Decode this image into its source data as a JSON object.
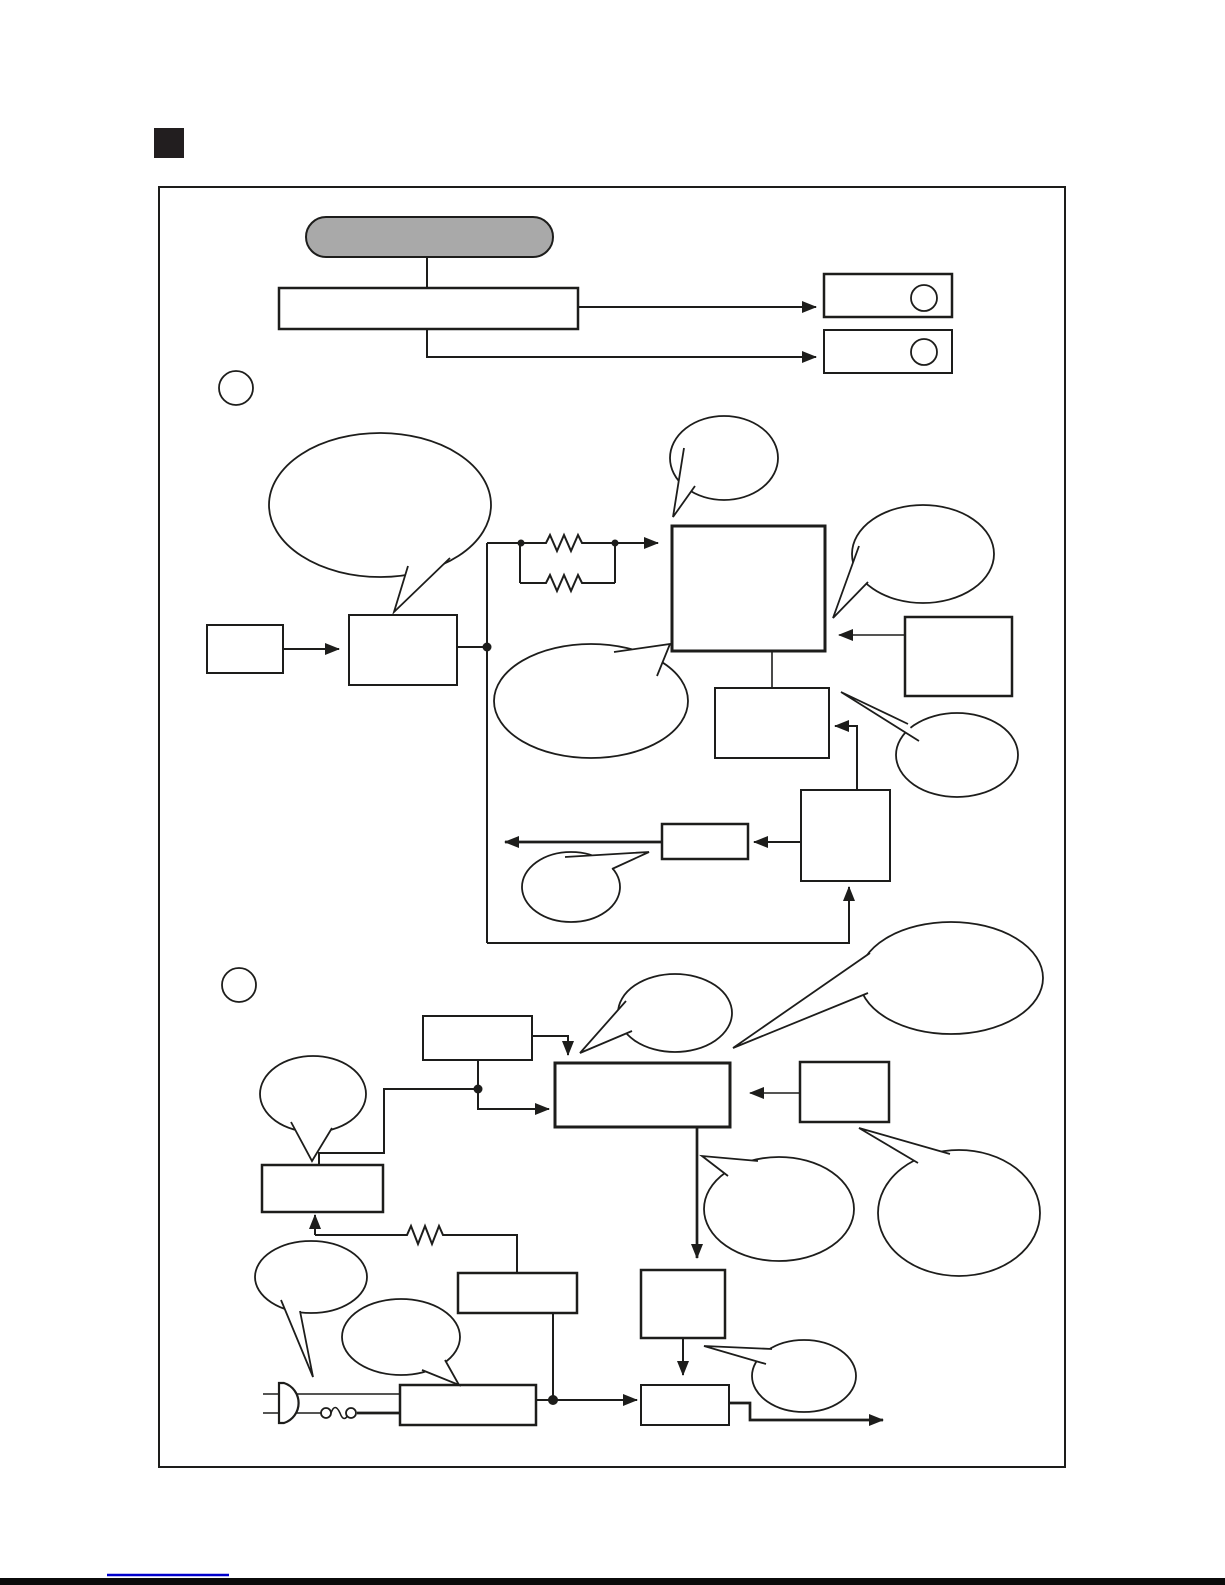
{
  "colors": {
    "ink": "#1d1d1b",
    "pill_fill": "#a9a9a9",
    "shape_fill": "#ffffff",
    "blue_underline": "#0000cc",
    "bottom_bar": "#0b0b0b",
    "marker_square": "#221e1f"
  },
  "diagram": {
    "description": "Service-manual style two-section flow/block diagram; every shape is blank (no text rendered in the screenshot)",
    "section_count": 2,
    "shape_counts": {
      "rectangle_boxes": 18,
      "rounded_start_pill": 1,
      "speech_bubbles": 14,
      "resistor_symbols": 3,
      "junction_dots": 5,
      "indicator_circle_boxes": 2,
      "section_marker_circles": 2,
      "ac_plug_symbols": 1,
      "fuse_symbols": 1
    }
  }
}
